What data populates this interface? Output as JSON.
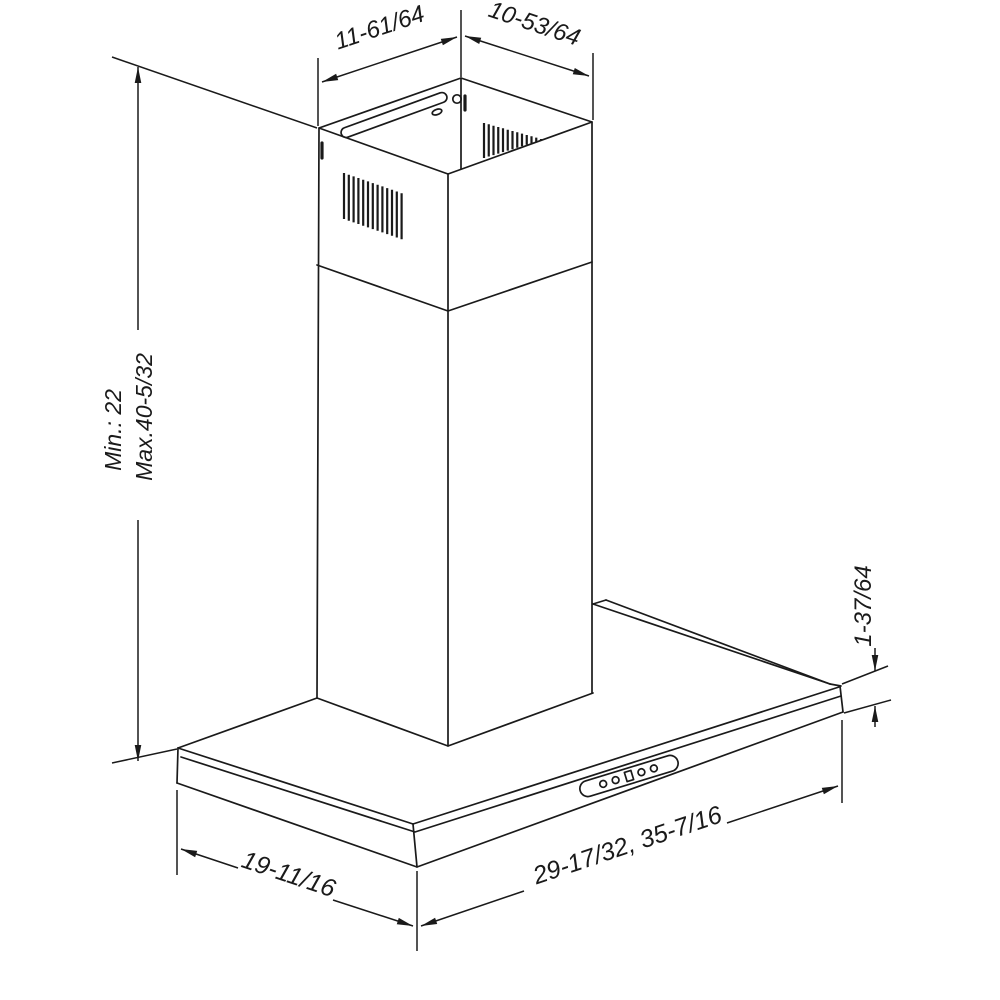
{
  "diagram": {
    "kind": "isometric dimension drawing",
    "subject": "wall-mount chimney range hood",
    "colors": {
      "line": "#1a1a1a",
      "background": "#ffffff"
    },
    "labels": {
      "duct_width_left": "11-61/64",
      "duct_depth_right": "10-53/64",
      "height_min": "Min.: 22",
      "height_max": "Max.40-5/32",
      "lip_height": "1-37/64",
      "canopy_depth": "19-11/16",
      "canopy_width": "29-17/32, 35-7/16"
    }
  }
}
